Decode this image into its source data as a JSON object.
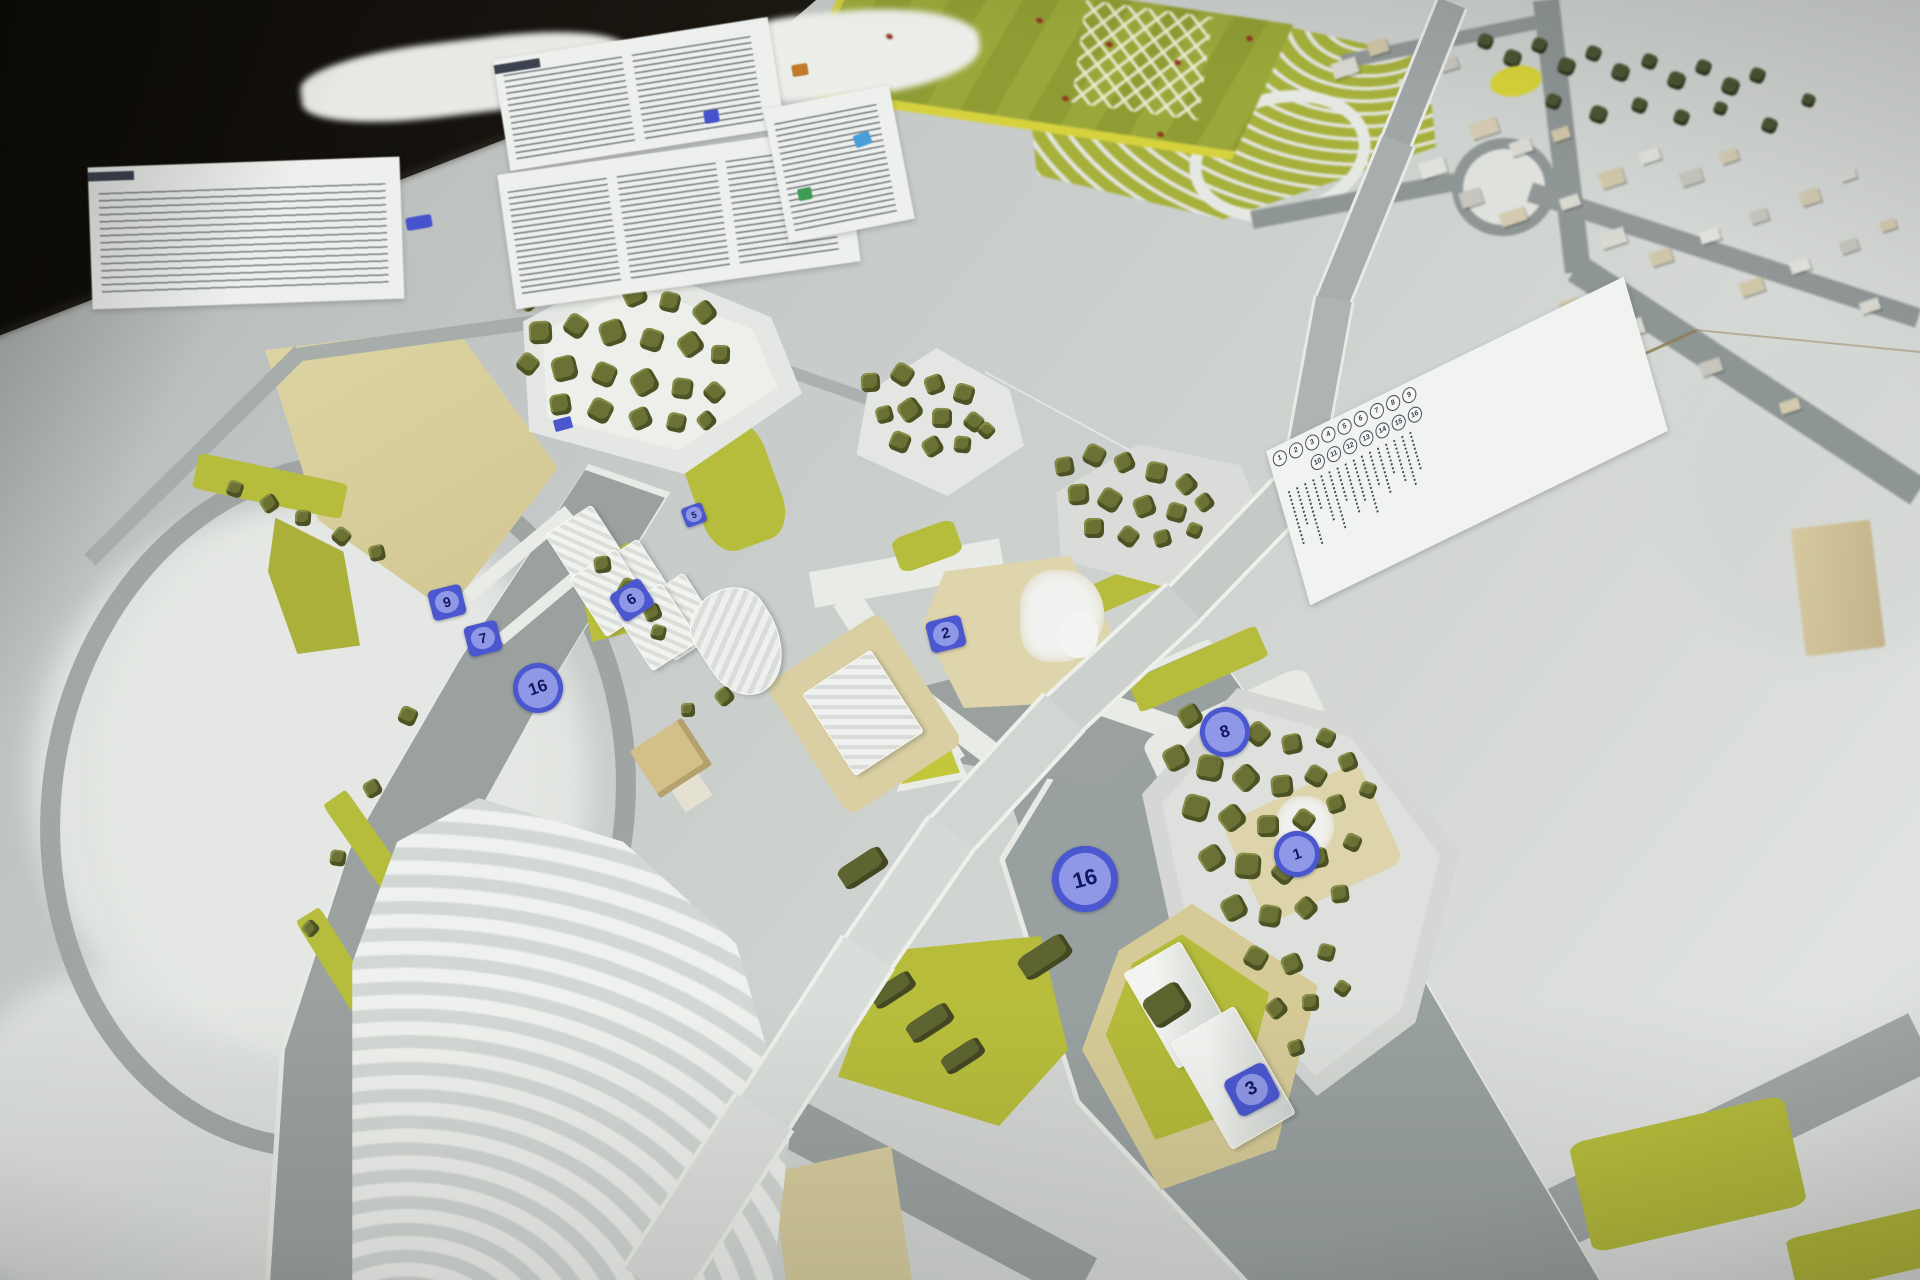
{
  "scene": {
    "subject": "urban-planning-scale-model",
    "colors": {
      "background_dark": "#1a1712",
      "model_surface": "#cfd3d0",
      "road_gray": "#9aa19f",
      "lawn_chartreuse": "#b7bd3b",
      "tree_olive": "#6b7134",
      "context_tree_dark": "#4b5433",
      "plot_beige": "#d7cd9b",
      "bridge_silver": "#aab0af",
      "ramp_white": "#d6dad7",
      "sports_field_green": "#9aa73a",
      "sports_field_edge_yellow": "#d6d23e",
      "paper_white": "#eef0ee",
      "marker_blue": "#4a57cf",
      "marker_disc": "#8f98e6",
      "marker_number": "#12175e",
      "field_dot_red": "#8f3420",
      "crack_brown": "#8d7c50"
    }
  },
  "markers": [
    {
      "label": "9",
      "shape": "square",
      "x": 447,
      "y": 604,
      "size": 34,
      "rot": -14
    },
    {
      "label": "7",
      "shape": "square",
      "x": 483,
      "y": 640,
      "size": 34,
      "rot": -14
    },
    {
      "label": "16",
      "shape": "circle",
      "x": 533,
      "y": 683,
      "size": 40,
      "rot": -20
    },
    {
      "label": "6",
      "shape": "square",
      "x": 632,
      "y": 602,
      "size": 36,
      "rot": -33
    },
    {
      "label": "5",
      "shape": "square",
      "x": 694,
      "y": 516,
      "size": 22,
      "rot": -20
    },
    {
      "label": "2",
      "shape": "square",
      "x": 946,
      "y": 636,
      "size": 36,
      "rot": -14
    },
    {
      "label": "8",
      "shape": "circle",
      "x": 1220,
      "y": 727,
      "size": 40,
      "rot": -18
    },
    {
      "label": "1",
      "shape": "circle",
      "x": 1292,
      "y": 849,
      "size": 36,
      "rot": -18
    },
    {
      "label": "16",
      "shape": "circle",
      "x": 1078,
      "y": 872,
      "size": 52,
      "rot": -15
    },
    {
      "label": "3",
      "shape": "square",
      "x": 1252,
      "y": 1092,
      "size": 46,
      "rot": -28
    },
    {
      "label": "",
      "shape": "tag",
      "x": 563,
      "y": 424,
      "size": 18,
      "rot": -15
    }
  ],
  "paper_tags": [
    {
      "name": "blue-tag-paper-d",
      "color": "#4553cd",
      "x": 406,
      "y": 216,
      "w": 26,
      "h": 13,
      "rot": -10
    },
    {
      "name": "blue-tag-paper-b",
      "color": "#4553cd",
      "x": 704,
      "y": 110,
      "w": 15,
      "h": 13,
      "rot": -9
    },
    {
      "name": "orange-tag-paper-a",
      "color": "#c07a28",
      "x": 792,
      "y": 64,
      "w": 16,
      "h": 12,
      "rot": -9
    },
    {
      "name": "cyan-tag-paper-c",
      "color": "#4a9ed8",
      "x": 854,
      "y": 133,
      "w": 17,
      "h": 13,
      "rot": -20
    },
    {
      "name": "green-tag-paper-c",
      "color": "#3f9a52",
      "x": 798,
      "y": 188,
      "w": 14,
      "h": 12,
      "rot": -11
    }
  ],
  "legend": {
    "numbers_row1": [
      "1",
      "2",
      "3",
      "4",
      "5",
      "6",
      "7",
      "8",
      "9"
    ],
    "numbers_row2": [
      "10",
      "11",
      "12",
      "13",
      "14",
      "15",
      "16"
    ]
  },
  "field_dots": [
    {
      "x": 1036,
      "y": 18
    },
    {
      "x": 1106,
      "y": 42
    },
    {
      "x": 1174,
      "y": 60
    },
    {
      "x": 1157,
      "y": 132
    },
    {
      "x": 1246,
      "y": 36
    },
    {
      "x": 1062,
      "y": 96
    },
    {
      "x": 886,
      "y": 34
    }
  ]
}
